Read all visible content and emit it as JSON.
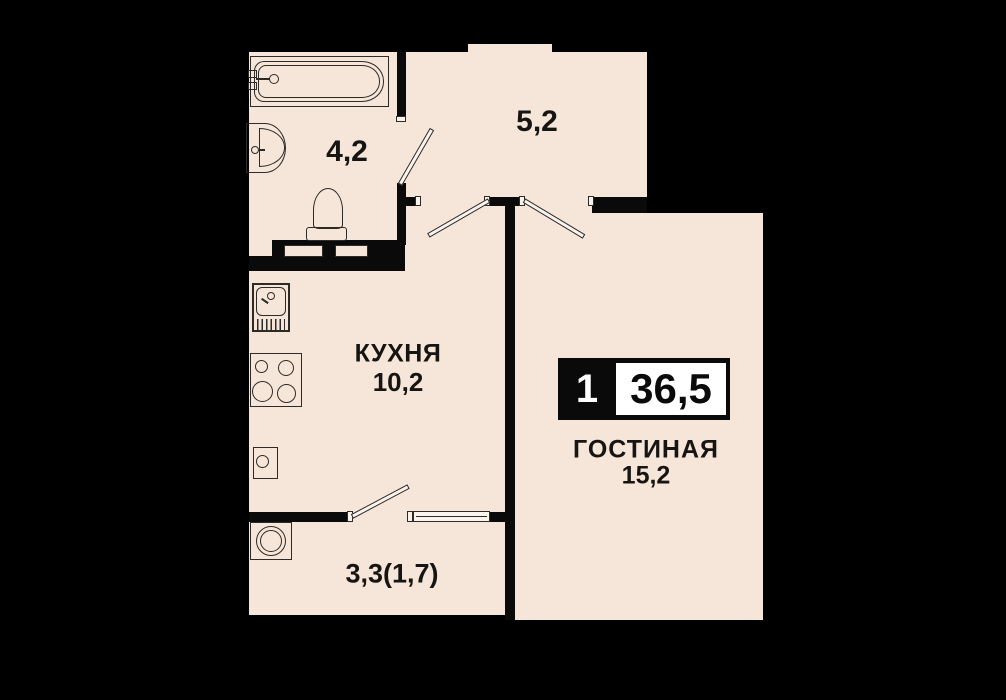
{
  "title": "1-room apartment floor plan",
  "colors": {
    "background": "#000000",
    "floor": "#f6e6da",
    "wall": "#0a0a0a",
    "outline": "#2e2a26",
    "text": "#171512",
    "badge_bg": "#0a0a0a",
    "badge_box": "#ffffff"
  },
  "badge": {
    "rooms_count": "1",
    "total_area": "36,5"
  },
  "rooms": {
    "bathroom": {
      "area": "4,2"
    },
    "hallway": {
      "area": "5,2"
    },
    "kitchen": {
      "name": "КУХНЯ",
      "area": "10,2"
    },
    "living": {
      "name": "ГОСТИНАЯ",
      "area": "15,2"
    },
    "loggia": {
      "area": "3,3(1,7)"
    }
  },
  "fixtures": [
    "bathtub-icon",
    "bath-sink-icon",
    "toilet-icon",
    "kitchen-sink-icon",
    "stove-icon",
    "water-heater-icon",
    "washing-machine-icon",
    "door-leaf-icon",
    "window-icon"
  ]
}
